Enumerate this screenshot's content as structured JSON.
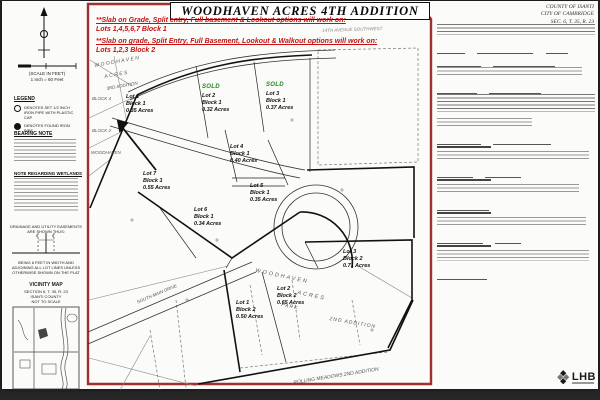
{
  "document": {
    "county_line1": "COUNTY OF ISANTI",
    "county_line2": "CITY OF CAMBRIDGE",
    "county_line3": "SEC. 6, T. 35, R. 23",
    "title": "WOODHAVEN ACRES 4TH ADDITION"
  },
  "red_notes": {
    "note1_text": "**Slab on Grade, Split entry, Full basement & Lookout options will work on:",
    "note1_lots": "Lots 1,4,5,6,7 Block 1",
    "note2_text": "**Slab on grade, Split Entry, Full Basement, Lookout & Walkout options will work on:",
    "note2_lots": "Lots 1,2,3 Block 2",
    "accent_color": "#c41212"
  },
  "sidebar": {
    "scale_caption": "(SCALE IN FEET)",
    "scale_ratio": "1 Inch = 60 Feet",
    "legend_title": "LEGEND",
    "legend_items": [
      {
        "symbol": "open-circle",
        "label": "DENOTES SET 1/2 INCH IRON PIPE WITH PLASTIC CAP"
      },
      {
        "symbol": "filled-circle",
        "label": "DENOTES FOUND IRON PIPE"
      }
    ],
    "bearing_note_title": "BEARING NOTE",
    "wetlands_note_title": "NOTE REGARDING WETLANDS",
    "easement_note": "DRAINAGE AND UTILITY EASEMENTS ARE SHOWN THUS:",
    "easement_widths": [
      "6",
      "6"
    ],
    "easement_caption": "BEING 6 FEET IN WIDTH AND ADJOINING ALL LOT LINES UNLESS OTHERWISE SHOWN ON THE PLAT",
    "vicinity_title": "VICINITY MAP",
    "vicinity_line1": "SECTION 6, T. 35, R. 23",
    "vicinity_line2": "ISANTI COUNTY",
    "vicinity_line3": "NOT TO SCALE"
  },
  "map": {
    "sold_label": "SOLD",
    "sold_color": "#1e8a1e",
    "lots": [
      {
        "name": "Lot 1",
        "block": "Block 1",
        "acres": "0.35 Acres",
        "sold": false
      },
      {
        "name": "Lot 2",
        "block": "Block 1",
        "acres": "0.32 Acres",
        "sold": true
      },
      {
        "name": "Lot 3",
        "block": "Block 1",
        "acres": "0.37 Acres",
        "sold": true
      },
      {
        "name": "Lot 4",
        "block": "Block 1",
        "acres": "0.40 Acres",
        "sold": false
      },
      {
        "name": "Lot 5",
        "block": "Block 1",
        "acres": "0.35 Acres",
        "sold": false
      },
      {
        "name": "Lot 6",
        "block": "Block 1",
        "acres": "0.34 Acres",
        "sold": false
      },
      {
        "name": "Lot 7",
        "block": "Block 1",
        "acres": "0.55 Acres",
        "sold": false
      },
      {
        "name": "Lot 1",
        "block": "Block 2",
        "acres": "0.50 Acres",
        "sold": false
      },
      {
        "name": "Lot 2",
        "block": "Block 2",
        "acres": "0.65 Acres",
        "sold": false
      },
      {
        "name": "Lot 3",
        "block": "Block 2",
        "acres": "0.71 Acres",
        "sold": false
      }
    ],
    "area_labels": [
      "WOODHAVEN",
      "ACRES",
      "3RD ADDITION",
      "BLOCK 4",
      "BLOCK 2",
      "WOODHAVEN",
      "WOODHAVEN",
      "ACRES",
      "PARK",
      "2ND ADDITION",
      "ROLLING MEADOWS 2ND ADDITION"
    ],
    "street_labels": {
      "avenue": "14TH AVENUE SOUTHWEST",
      "drive": "SOUTH MAIN DRIVE"
    }
  },
  "logo": {
    "name": "LHB"
  }
}
